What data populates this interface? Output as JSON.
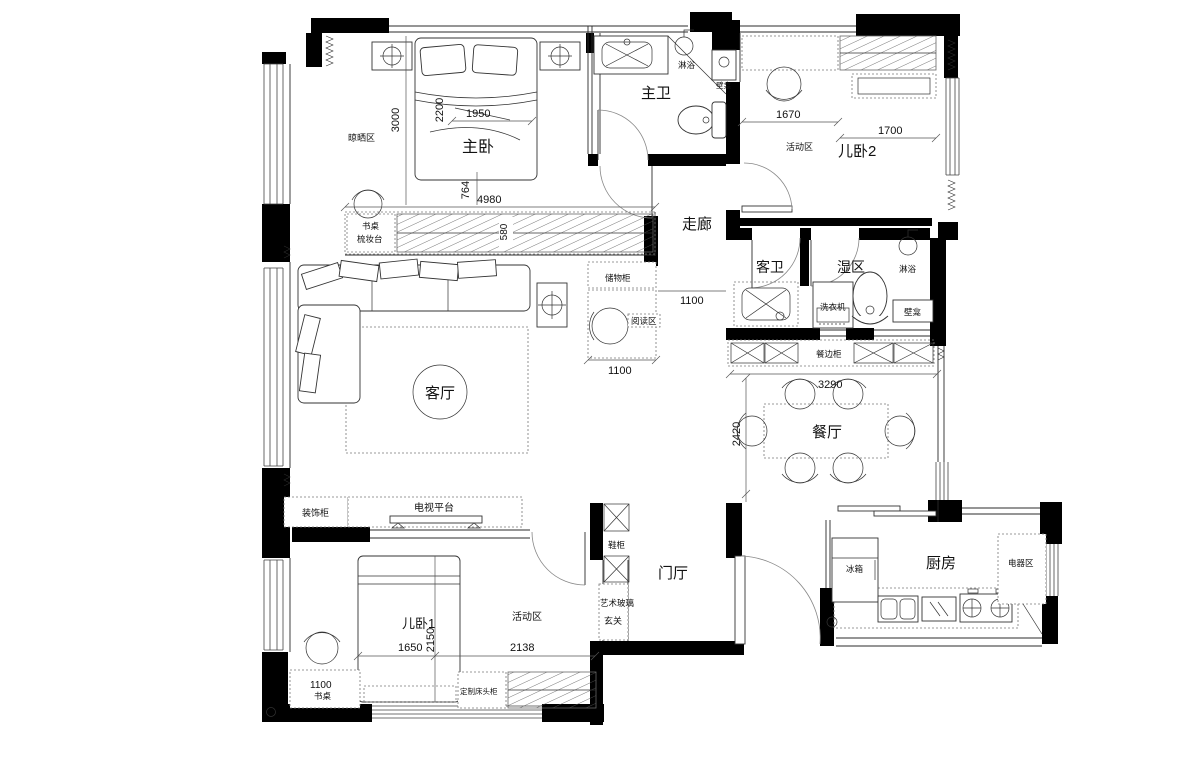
{
  "labels": {
    "master_bedroom": "主卧",
    "master_bath": "主卫",
    "kids_room2": "儿卧2",
    "corridor": "走廊",
    "guest_bath": "客卫",
    "wet_area": "湿区",
    "living_room": "客厅",
    "dining_room": "餐厅",
    "kitchen": "厨房",
    "foyer": "门厅",
    "kids_room1": "儿卧1",
    "drying_zone": "晾晒区",
    "activity_zone2": "活动区",
    "activity_zone1": "活动区",
    "reading_zone": "阅读区",
    "entry_zone": "玄关",
    "shower_master": "淋浴",
    "niche_master": "壁龛",
    "shower_wet": "淋浴",
    "niche_wet": "壁龛",
    "washing_machine": "洗衣机",
    "storage_cabinet": "储物柜",
    "desk_label": "书桌",
    "dresser_label": "梳妆台",
    "sideboard": "餐边柜",
    "decor_cabinet": "装饰柜",
    "tv_platform": "电视平台",
    "shoe_cabinet": "鞋柜",
    "art_glass": "艺术玻璃",
    "desk1": "书桌",
    "custom_headboard": "定制床头柜",
    "fridge": "冰箱",
    "appliance_area": "电器区"
  },
  "dimensions": {
    "master_depth": "3000",
    "bed_length": "2200",
    "bed_width": "1950",
    "gap_764": "764",
    "master_width": "4980",
    "wardrobe_580": "580",
    "k2_1670": "1670",
    "k2_1700": "1700",
    "corridor_1100": "1100",
    "reading_1100": "1100",
    "dining_3290": "3290",
    "dining_2420": "2420",
    "bed1_1650": "1650",
    "bed1_2150": "2150",
    "activity_2138": "2138",
    "desk_1100": "1100"
  }
}
